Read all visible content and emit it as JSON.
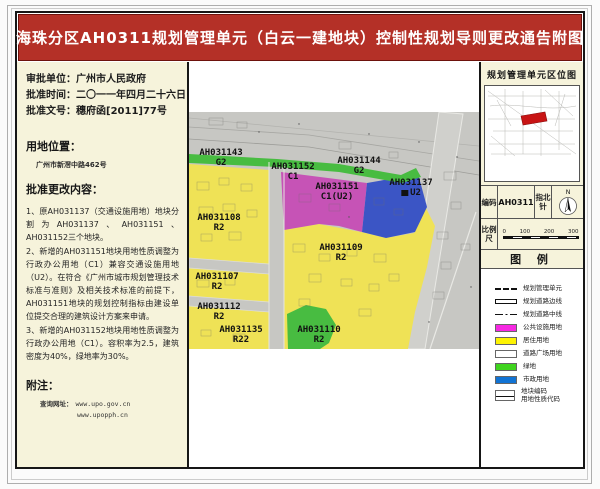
{
  "title": "海珠分区AH0311规划管理单元（白云一建地块）控制性规划导则更改通告附图",
  "colors": {
    "title_red": "#b43027",
    "yellow": "#efe256",
    "magenta": "#c653b6",
    "blue": "#3b55c5",
    "green": "#48bc41",
    "highlight_red": "#c81414"
  },
  "left_panel": {
    "approval_lines": [
      {
        "label": "审批单位：",
        "value": "广州市人民政府"
      },
      {
        "label": "批准时间：",
        "value": "二〇一一年四月二十六日"
      },
      {
        "label": "批准文号：",
        "value": "穗府函[2011]77号"
      }
    ],
    "location_heading": "用地位置：",
    "location_value": "广州市新滘中路462号",
    "content_heading": "批准更改内容：",
    "content_paragraphs": [
      "1、原AH031137（交通设施用地）地块分割为AH031137、AH031151、AH031152三个地块。",
      "2、新增的AH031151地块用地性质调整为行政办公用地（C1）兼容交通设施用地（U2）。在符合《广州市城市规划管理技术标准与准则》及相关技术标准的前提下，AH031151地块的规划控制指标由建设单位提交合理的建筑设计方案来申请。",
      "3、新增的AH031152地块用地性质调整为行政办公用地（C1）。容积率为2.5，建筑密度为40%，绿地率为30%。"
    ],
    "note_heading": "附注：",
    "note_label": "查询网址：",
    "note_urls": [
      "www.upo.gov.cn",
      "www.upopph.cn"
    ]
  },
  "map": {
    "labels": [
      {
        "code": "AH031143",
        "type": "G2",
        "x": 32,
        "y": 36
      },
      {
        "code": "AH031152",
        "type": "C1",
        "x": 104,
        "y": 50
      },
      {
        "code": "AH031144",
        "type": "G2",
        "x": 170,
        "y": 44
      },
      {
        "code": "AH031151",
        "type": "C1(U2)",
        "x": 148,
        "y": 70
      },
      {
        "code": "AH031137",
        "type": "U2",
        "x": 222,
        "y": 66,
        "square": true
      },
      {
        "code": "AH031108",
        "type": "R2",
        "x": 30,
        "y": 101
      },
      {
        "code": "AH031109",
        "type": "R2",
        "x": 152,
        "y": 131
      },
      {
        "code": "AH031107",
        "type": "R2",
        "x": 28,
        "y": 160
      },
      {
        "code": "AH031112",
        "type": "R2",
        "x": 30,
        "y": 190
      },
      {
        "code": "AH031135",
        "type": "R22",
        "x": 52,
        "y": 213
      },
      {
        "code": "AH031110",
        "type": "R2",
        "x": 130,
        "y": 213
      }
    ]
  },
  "right_panel": {
    "location_map_title": "规划管理单元区位图",
    "code_label": "编码",
    "code_value": "AH0311",
    "compass_label": "指北针",
    "compass_n": "N",
    "scale_label": "比例尺",
    "scale_ticks": [
      "0",
      "100",
      "200",
      "300"
    ],
    "legend_title": "图 例",
    "legend_items": [
      {
        "symbol": "dashed",
        "label": "规划管理单元"
      },
      {
        "symbol": "solid",
        "label": "规划道路边线"
      },
      {
        "symbol": "dashdot",
        "label": "规划道路中线"
      },
      {
        "symbol": "swatch",
        "color": "#f628e2",
        "label": "公共设施用地"
      },
      {
        "symbol": "swatch",
        "color": "#fdf303",
        "label": "居住用地"
      },
      {
        "symbol": "swatch_outline",
        "color": "#ffffff",
        "label": "道路广场用地"
      },
      {
        "symbol": "swatch",
        "color": "#3fd41e",
        "label": "绿地"
      },
      {
        "symbol": "swatch",
        "color": "#1173d4",
        "label": "市政用地"
      },
      {
        "symbol": "code",
        "label": "地块编码",
        "label2": "用地性质代码"
      }
    ]
  }
}
